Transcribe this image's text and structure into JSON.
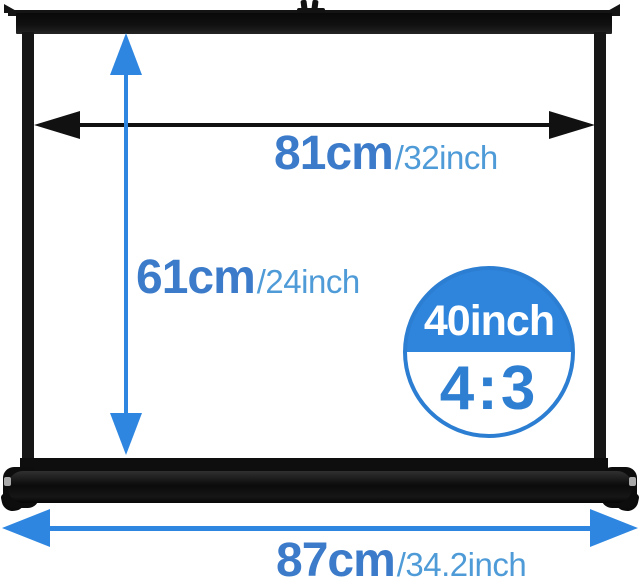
{
  "labels": {
    "width": {
      "cm": "81cm",
      "inch": "/32inch"
    },
    "height": {
      "cm": "61cm",
      "inch": "/24inch"
    },
    "base": {
      "cm": "87cm",
      "inch": "/34.2inch"
    }
  },
  "badge": {
    "size": "40inch",
    "ratio": "4:3"
  },
  "colors": {
    "arrow_blue": "#2e86e0",
    "badge_fill_blue": "#2f85dc",
    "badge_border_blue": "#2c7ed2",
    "badge_text_blue": "#2e7fd2",
    "label_cm_blue": "#3b7bca",
    "label_inch_blue": "#4e9bd8",
    "dimension_arrow_black": "#111111",
    "frame_black": "#161616",
    "background": "#ffffff"
  }
}
